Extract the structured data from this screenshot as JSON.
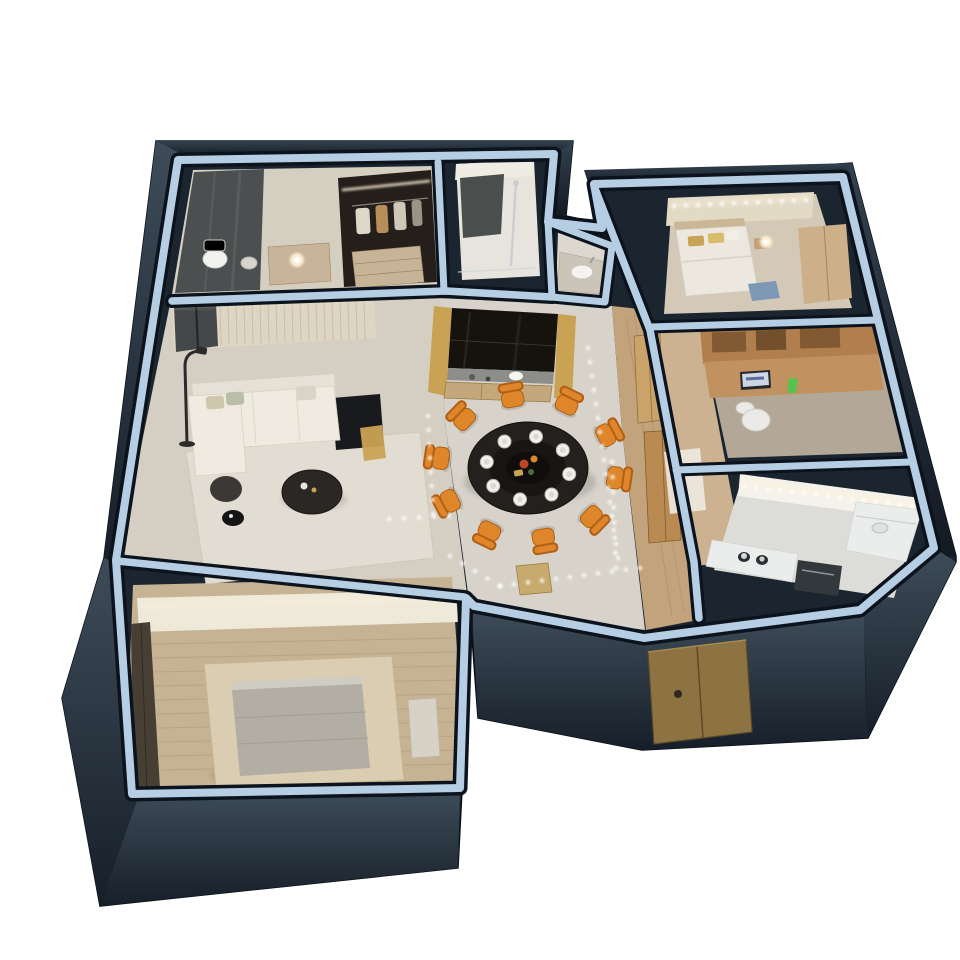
{
  "scene": {
    "type": "3d-apartment-floorplan-dollhouse-render",
    "background": "#ffffff",
    "view": "axonometric-cutaway"
  },
  "palette": {
    "silhouette": "#1b2530",
    "facade_top": "#3e4c59",
    "facade_bottom": "#161f29",
    "band": "#b6cee3",
    "band_edge": "#0c131c",
    "floor_bath": "#d5cfc2",
    "floor_shower": "#e7e4dd",
    "floor_niche": "#ddd8cf",
    "floor_bedroom_tr": "#d3c9b6",
    "floor_study": "#b3a897",
    "floor_kitchen": "#dcdcd8",
    "floor_dining": "#d7d3ca",
    "floor_living": "#d5cec2",
    "floor_hall_wood": "#c2a37b",
    "floor_corridor_wood": "#cdb292",
    "floor_bedroom_bl": "#c6b394",
    "rug": "#e2ddd2",
    "sofa": "#efebe1",
    "sofa_back": "#e6e1d6",
    "chair_orange": "#e0862a",
    "chair_orange_dark": "#b05f16",
    "table_dark": "#23201d",
    "door_bronze": "#8e7342",
    "wardrobe_dark": "#241f1a",
    "glass_dark": "#44484a",
    "gold": "#c9a254",
    "counter": "#ebedec",
    "wood_desk": "#c1925f",
    "wood_shelf": "#b07f4d",
    "wall_face_beige": "#e3dac6",
    "wall_face_white": "#efe9da",
    "slat_wall": "#ded5c2",
    "mattress": "#b2aea4",
    "bed_platform": "#dbcdb2",
    "appliance": "#33383c",
    "bench_blue": "#7d98b5",
    "phone_green": "#57c24e",
    "glow": "#fff2d8"
  },
  "dining": {
    "chair_count": 10,
    "chair_start_deg": 8,
    "chair_ring": {
      "cx": 528,
      "cy": 468,
      "rx": 92,
      "ry": 74
    },
    "plate_count": 8,
    "plate_start_deg": 11,
    "plate_ring": {
      "rx": 42,
      "ry": 32
    },
    "table": {
      "cx": 528,
      "cy": 468,
      "rx": 60,
      "ry": 46
    }
  },
  "led_lines": [
    {
      "x1": 428,
      "y1": 416,
      "x2": 433,
      "y2": 514,
      "step": 13
    },
    {
      "x1": 389,
      "y1": 519,
      "x2": 449,
      "y2": 516,
      "step": 13
    },
    {
      "x1": 450,
      "y1": 556,
      "x2": 500,
      "y2": 586,
      "step": 14
    },
    {
      "x1": 500,
      "y1": 586,
      "x2": 640,
      "y2": 568,
      "step": 14
    },
    {
      "x1": 588,
      "y1": 348,
      "x2": 618,
      "y2": 558,
      "step": 14
    },
    {
      "x1": 612,
      "y1": 462,
      "x2": 616,
      "y2": 568,
      "step": 14
    },
    {
      "x1": 744,
      "y1": 486,
      "x2": 912,
      "y2": 506,
      "step": 12
    },
    {
      "x1": 674,
      "y1": 206,
      "x2": 806,
      "y2": 200,
      "step": 12
    }
  ],
  "living": {
    "slats": {
      "x1": 180,
      "x2": 368,
      "step": 8,
      "ytopA": 304,
      "ytopB": 297,
      "height": 42
    }
  },
  "bedroom_bl": {
    "planks": {
      "y1": 644,
      "y2": 780,
      "step": 14
    }
  },
  "rooms": [
    {
      "id": "bathroom-dressing",
      "features": [
        "glass-shower",
        "toilet",
        "stool",
        "vanity",
        "wardrobe-with-clothes",
        "drawers"
      ]
    },
    {
      "id": "shower-room",
      "features": [
        "dark-panel",
        "shower-column"
      ]
    },
    {
      "id": "wash-niche",
      "features": [
        "basin-counter"
      ]
    },
    {
      "id": "bedroom-small",
      "features": [
        "bed",
        "gold-pillows",
        "nightstand-lamp",
        "blue-bench",
        "closet"
      ]
    },
    {
      "id": "study",
      "features": [
        "wall-shelves",
        "wood-desk",
        "laptop",
        "green-phone",
        "office-chair"
      ]
    },
    {
      "id": "kitchen",
      "features": [
        "l-counter",
        "cooktop",
        "dark-appliance",
        "light-strip"
      ]
    },
    {
      "id": "hallway",
      "features": [
        "wood-floor",
        "closet-panels",
        "interior-door",
        "led-dots",
        "mat"
      ]
    },
    {
      "id": "dining-area",
      "features": [
        "round-black-table",
        "white-plates",
        "orange-chairs",
        "led-floor-dots"
      ]
    },
    {
      "id": "display-cabinet",
      "features": [
        "dark-glass-cabinet",
        "gold-side-panels",
        "figurine",
        "drawers"
      ]
    },
    {
      "id": "living-room",
      "features": [
        "l-sofa",
        "pillows",
        "coffee-table",
        "ottoman",
        "side-table",
        "floor-lamp",
        "rug",
        "tv-console",
        "gold-table",
        "slat-wall",
        "window"
      ]
    },
    {
      "id": "bedroom-master",
      "features": [
        "platform-bed",
        "gray-mattress",
        "closet",
        "wood-plank-floor",
        "bench"
      ]
    },
    {
      "id": "entry",
      "features": [
        "bronze-door",
        "door-seam",
        "round-handle"
      ]
    }
  ]
}
